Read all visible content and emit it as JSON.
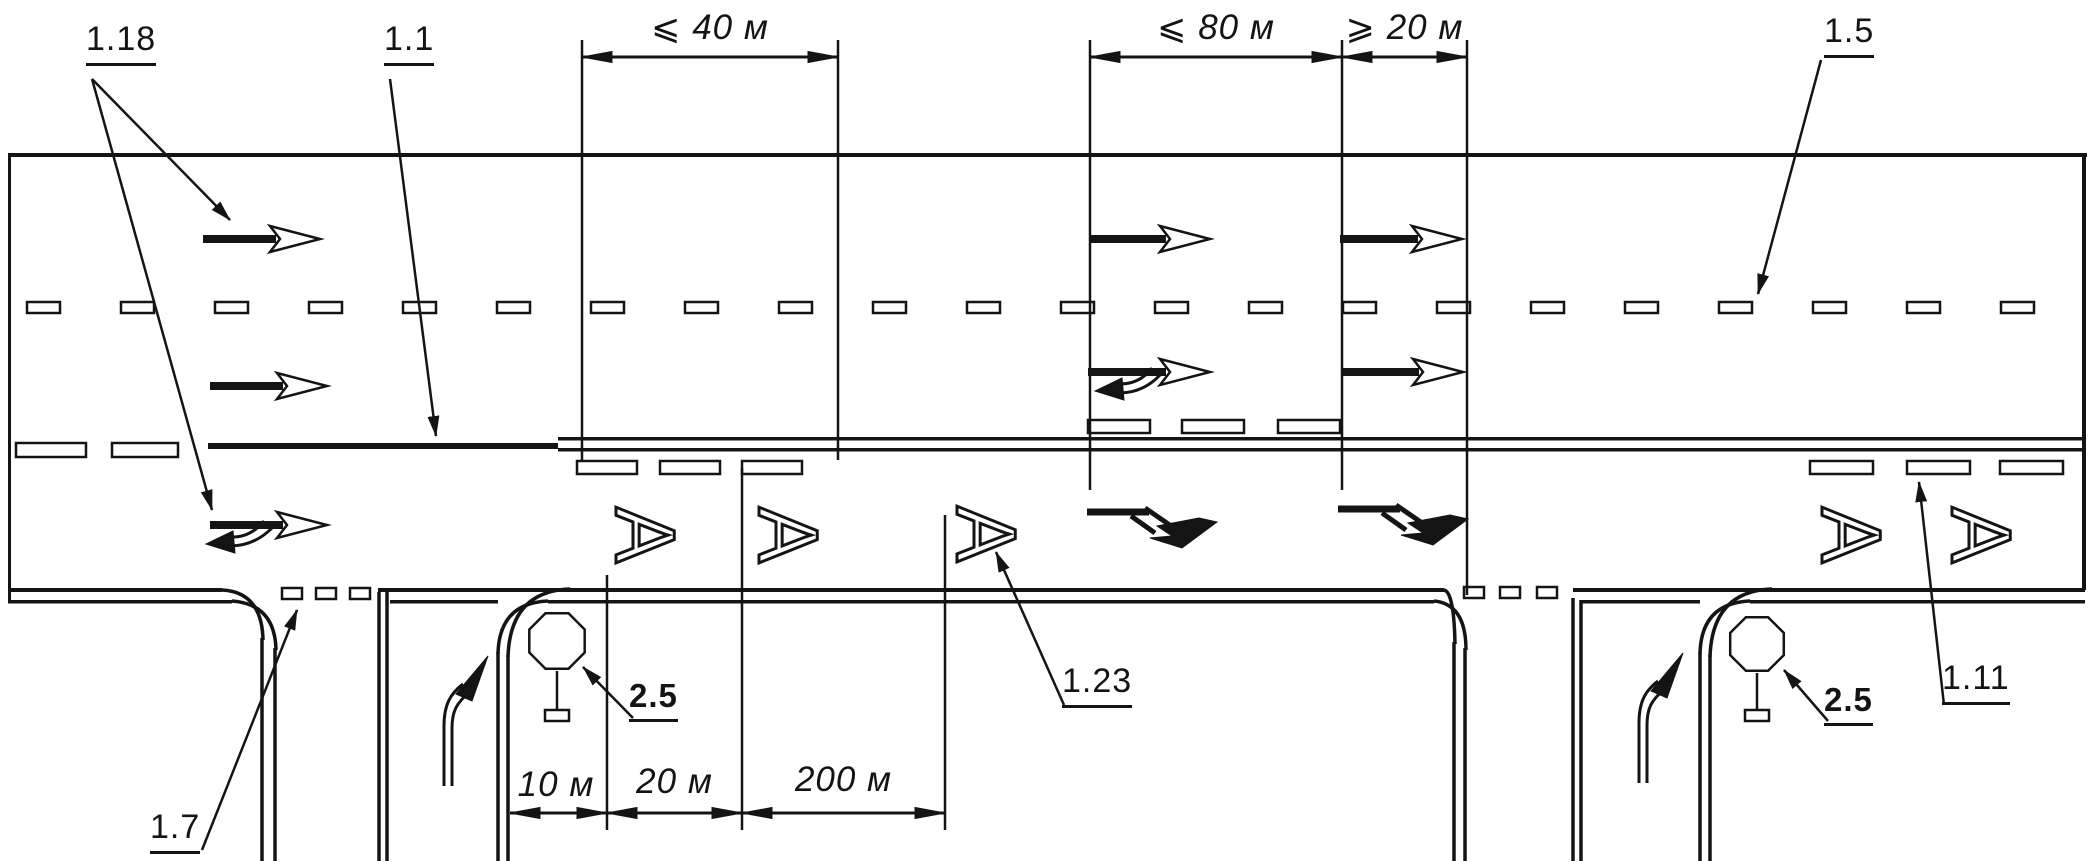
{
  "meta": {
    "title": "Road marking scheme — dedicated bus lane with side-road intersections",
    "ink_color": "#141414",
    "paper_color": "#ffffff"
  },
  "marking_labels": {
    "m118": "1.18",
    "m11": "1.1",
    "m15": "1.5",
    "m17": "1.7",
    "m123": "1.23",
    "m111": "1.11",
    "sign25_left": "2.5",
    "sign25_right": "2.5"
  },
  "dimensions": {
    "top_40": "⩽ 40 м",
    "top_80": "⩽ 80 м",
    "top_20": "⩾ 20 м",
    "bottom_10": "10 м",
    "bottom_20": "20 м",
    "bottom_200": "200 м"
  },
  "road": {
    "bus_lane_letter": "А"
  }
}
